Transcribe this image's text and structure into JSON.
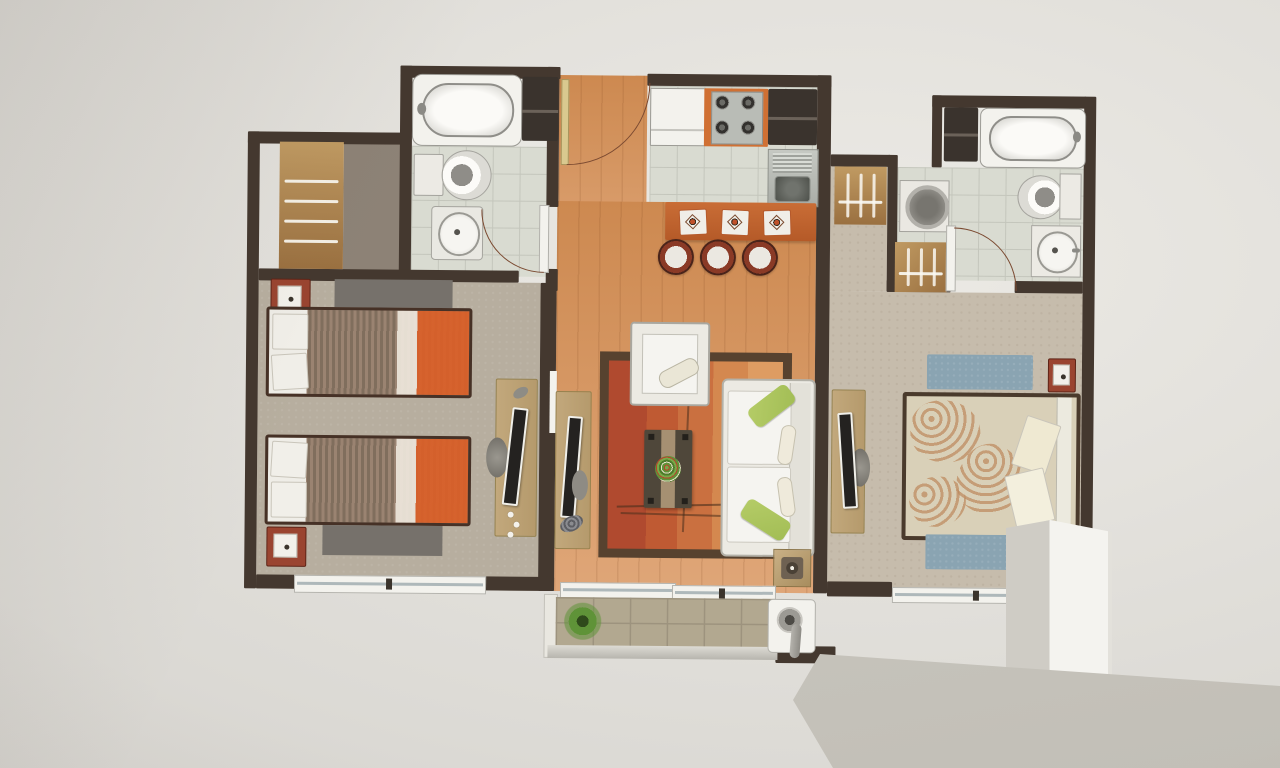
{
  "scene": {
    "subject": "photograph of a two-bedroom apartment floor plan poster mounted on a pale wall, partially occluded at bottom right by a white column and a sloping white parapet ledge in the foreground"
  },
  "colors": {
    "wall_bg": "#dcdad5",
    "wall_bg_light": "#eceae5",
    "wall_bg_dark": "#cfccc7",
    "wall_dark": "#44382f",
    "arc": "#7b4a31",
    "wood_light": "#dfa678",
    "wood_dark": "#cd8950",
    "tile": "#d9dbd1",
    "grout": "#c4c6bc",
    "carpet_1": "#b7ae9f",
    "carpet_2": "#c6bcac",
    "dressing": "#8d8276",
    "rug_gray": "#76716b",
    "rug_blue": "#8aa4b2",
    "closet_a": "#c09a62",
    "closet_b": "#9a7040",
    "accent_red": "#9a4430",
    "bar_orange": "#c96d36",
    "stove_orange": "#d07033",
    "steel": "#b9bcb6",
    "appliance_dark": "#3a332d",
    "bed_frame": "#463126",
    "bed_orange": "#dd6a2c",
    "sofa": "#eceae3",
    "cushion": "#f5f4f0",
    "pillow_green": "#a2bd55",
    "rug_border": "#57422f",
    "rug_red": "#b04a2f",
    "rug_orange": "#ca7040",
    "rug_orange_light": "#de9c62",
    "table_dark": "#4f473a",
    "runner": "#a69072",
    "plant": "#5f9338",
    "desk_tan": "#c2a87c",
    "screen_dark": "#242220",
    "fixture_white": "#f3f2ed",
    "fixture_line": "#9b9a94",
    "terrace_tile": "#b2a890",
    "terrace_grout": "#9d937e",
    "pillar_light": "#f4f3ef",
    "pillar_shade": "#cfccc5",
    "rail_light": "#eae7e0",
    "rail_dark": "#c8c5bd"
  },
  "plan": {
    "rooms": [
      "bedroom-1",
      "bathroom-1",
      "dressing-closet",
      "entry-hall",
      "kitchen",
      "living-dining",
      "corridor",
      "bathroom-2",
      "laundry-nook",
      "bedroom-2",
      "terrace"
    ],
    "furniture": {
      "bedroom_1": [
        "twin-bed",
        "twin-bed",
        "nightstand-lamp",
        "nightstand-lamp",
        "gray-rug",
        "gray-rug",
        "desk-with-monitor",
        "window"
      ],
      "bathroom_1": [
        "bathtub",
        "toilet",
        "pedestal-sink",
        "cabinet",
        "door-swing"
      ],
      "kitchen": [
        "fridge-counter",
        "cooktop-4-burners",
        "tall-cabinets",
        "double-sink",
        "breakfast-bar",
        "placemat",
        "placemat",
        "placemat",
        "stool",
        "stool",
        "stool"
      ],
      "living_dining": [
        "entry-door-swing",
        "tv-console",
        "flat-tv",
        "area-rug",
        "armchair",
        "coffee-table-with-plant",
        "sofa",
        "green-pillow",
        "green-pillow",
        "side-table",
        "sliding-windows"
      ],
      "bathroom_2": [
        "bathtub",
        "toilet-with-tank",
        "vanity-sink",
        "washing-machine",
        "linen-closet",
        "cabinet",
        "door-swing"
      ],
      "bedroom_2": [
        "double-bed",
        "headboard",
        "pillows",
        "blue-rug",
        "blue-rug",
        "nightstand-lamp",
        "desk-with-monitor",
        "window"
      ],
      "terrace": [
        "tiled-deck",
        "potted-plant",
        "bbq-grill",
        "railing-band"
      ]
    }
  },
  "foreground": [
    "white-column",
    "sloped-parapet-ledge"
  ]
}
